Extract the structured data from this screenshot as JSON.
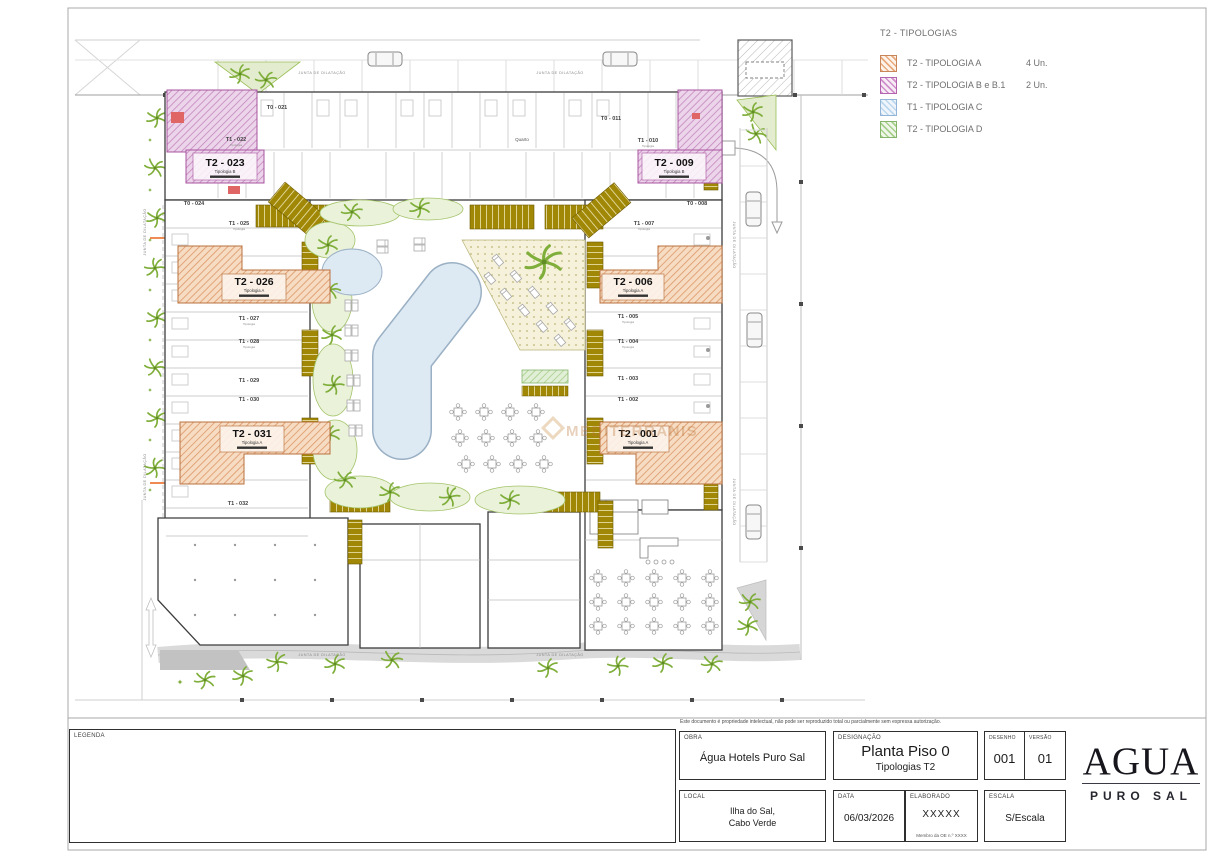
{
  "colors": {
    "tipologia_a": "#e8a06a",
    "tipologia_b": "#c77fc2",
    "tipologia_c": "#bdd7ee",
    "tipologia_d": "#a8d08d",
    "pool": "#dde9f3",
    "landscape_green": "#8ab53f",
    "deck_wood": "#9c8100",
    "wall": "#3c3c3c",
    "accent_red": "#e06666",
    "watermark": "#c9873f"
  },
  "legend_panel": {
    "title": "T2 - TIPOLOGIAS",
    "items": [
      {
        "label": "T2 - TIPOLOGIA A",
        "count": "4 Un."
      },
      {
        "label": "T2 - TIPOLOGIA B e B.1",
        "count": "2 Un."
      },
      {
        "label": "T1 - TIPOLOGIA C",
        "count": ""
      },
      {
        "label": "T2 - TIPOLOGIA D",
        "count": ""
      }
    ]
  },
  "plan": {
    "junta": "JUNTA DE DILATAÇÃO",
    "quarto": "Quarto",
    "tipologia_word": "Tipologia",
    "watermark": "MEDITERRANIS",
    "units_t2": [
      {
        "id": "T2 - 023",
        "tip": "Tipologia B"
      },
      {
        "id": "T2 - 009",
        "tip": "Tipologia B"
      },
      {
        "id": "T2 - 026",
        "tip": "Tipologia A"
      },
      {
        "id": "T2 - 031",
        "tip": "Tipologia A"
      },
      {
        "id": "T2 - 006",
        "tip": "Tipologia A"
      },
      {
        "id": "T2 - 001",
        "tip": "Tipologia A"
      }
    ],
    "units_small": [
      "T0 - 021",
      "T1 - 022",
      "T0 - 024",
      "T1 - 025",
      "T1 - 027",
      "T1 - 028",
      "T1 - 029",
      "T1 - 030",
      "T1 - 032",
      "T0 - 011",
      "T1 - 010",
      "T0 - 008",
      "T1 - 007",
      "T1 - 005",
      "T1 - 004",
      "T1 - 003",
      "T1 - 002"
    ]
  },
  "title_block": {
    "disclaimer": "Este documento é propriedade intelectual, não pode ser reproduzido total ou parcialmente sem expressa autorização.",
    "legenda_label": "LEGENDA",
    "obra_label": "OBRA",
    "obra_value": "Água Hotels Puro Sal",
    "designacao_label": "DESIGNAÇÃO",
    "designacao_value": "Planta Piso 0",
    "designacao_sub": "Tipologias T2",
    "desenho_label": "DESENHO",
    "desenho_value": "001",
    "versao_label": "VERSÃO",
    "versao_value": "01",
    "local_label": "LOCAL",
    "local_line1": "Ilha do Sal,",
    "local_line2": "Cabo Verde",
    "data_label": "DATA",
    "data_value": "06/03/2026",
    "elaborado_label": "ELABORADO",
    "elaborado_value": "XXXXX",
    "elaborado_sub": "Membro da OE n.º XXXX",
    "escala_label": "ESCALA",
    "escala_value": "S/Escala"
  },
  "logo": {
    "name": "AGUA",
    "subtitle": "PURO SAL"
  }
}
